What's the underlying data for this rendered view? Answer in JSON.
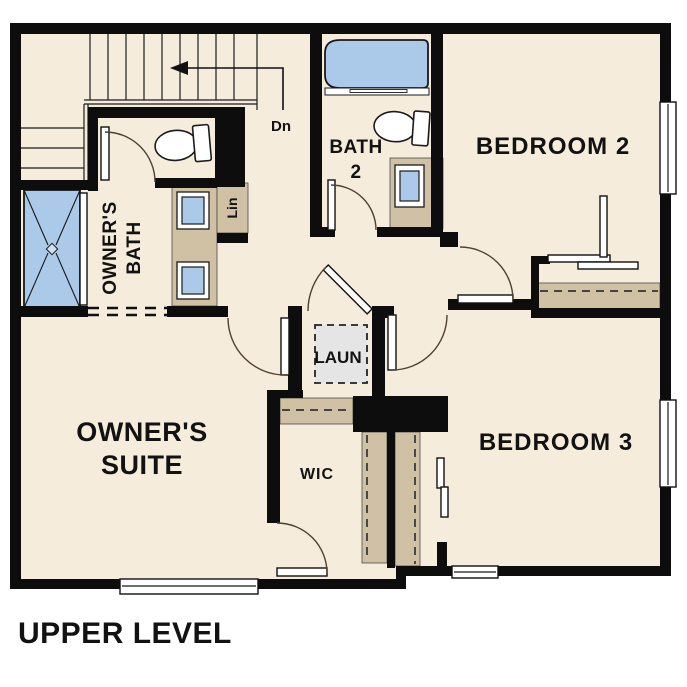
{
  "plan": {
    "title": "UPPER LEVEL"
  },
  "rooms": {
    "owners_suite": {
      "line1": "OWNER'S",
      "line2": "SUITE"
    },
    "owners_bath": {
      "line1": "OWNER'S",
      "line2": "BATH"
    },
    "bath2": {
      "line1": "BATH",
      "line2": "2"
    },
    "bedroom2": {
      "label": "BEDROOM 2"
    },
    "bedroom3": {
      "label": "BEDROOM 3"
    },
    "laundry": {
      "label": "LAUN"
    },
    "wic": {
      "label": "WIC"
    },
    "linen": {
      "label": "Lin"
    },
    "stairs": {
      "direction_label": "Dn"
    }
  },
  "colors": {
    "floor": "#f6ecdc",
    "wall": "#0d0d0d",
    "fixture_blue": "#abc9e9",
    "cabinet_tan": "#d0c1a5",
    "appliance_gray": "#e5e5e5",
    "door_arc": "#50412e"
  },
  "fixtures": [
    "shower",
    "bathtub",
    "toilet",
    "vanity-sink",
    "washer-dryer",
    "window",
    "stairs",
    "closet-rod"
  ]
}
